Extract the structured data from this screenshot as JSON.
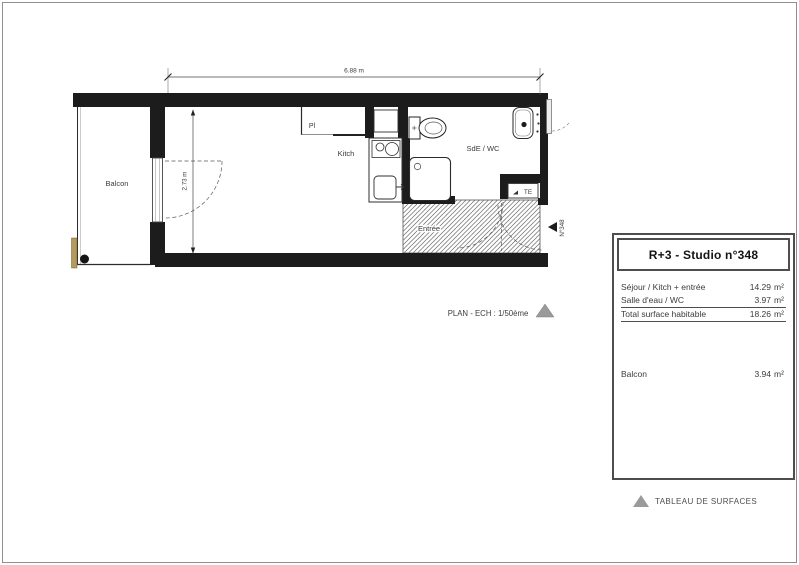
{
  "plan": {
    "rooms": {
      "balcony": "Balcon",
      "kitchen": "Kitch",
      "closet": "Pl",
      "bathroom": "SdE / WC",
      "entrance": "Entrée",
      "duct": "TE",
      "unit_door": "N°348"
    },
    "dimensions": {
      "width": "6.88 m",
      "depth": "2.73 m"
    },
    "scale_note": "PLAN - ECH : 1/50ème"
  },
  "table": {
    "title": "R+3 - Studio n°348",
    "rows": [
      {
        "label": "Séjour / Kitch + entrée",
        "value": "14.29",
        "unit": "m²"
      },
      {
        "label": "Salle d'eau / WC",
        "value": "3.97",
        "unit": "m²"
      },
      {
        "label": "Total surface habitable",
        "value": "18.26",
        "unit": "m²"
      }
    ],
    "balcony": {
      "label": "Balcon",
      "value": "3.94",
      "unit": "m²"
    }
  },
  "caption": "TABLEAU DE SURFACES",
  "colors": {
    "wall": "#1c1c1c",
    "hatch_line": "#6a6a6a",
    "balcony_divider_tan": "#b49b5d",
    "triangle_gray": "#9a9a9a"
  }
}
